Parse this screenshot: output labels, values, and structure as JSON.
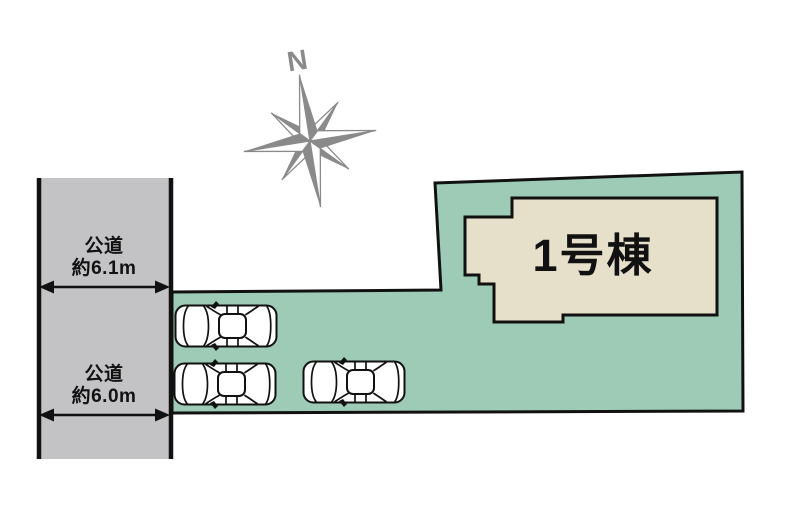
{
  "colors": {
    "plot_green": "#9ecbb6",
    "road_gray": "#c3c3c5",
    "house_beige": "#e6dfca",
    "compass_gray": "#8a8a8a",
    "line_black": "#111111"
  },
  "diagram": {
    "compass": {
      "north_label": "N"
    },
    "road": {
      "segments": [
        {
          "name": "公道",
          "width_label": "約6.1m"
        },
        {
          "name": "公道",
          "width_label": "約6.0m"
        }
      ]
    },
    "plot": {
      "building_label": "1号棟",
      "parked_cars": 3
    }
  }
}
